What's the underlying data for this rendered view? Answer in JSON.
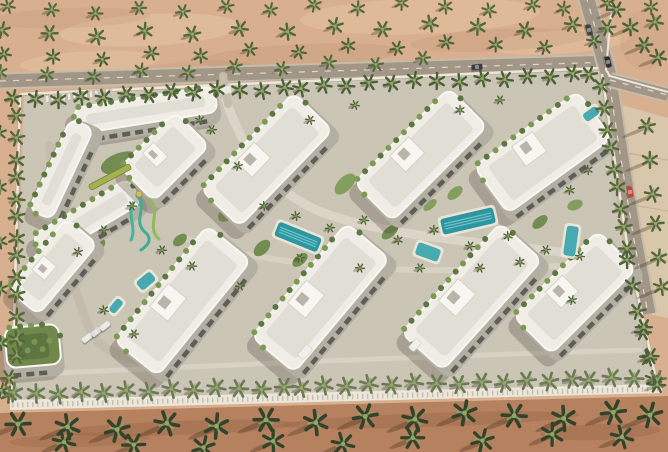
{
  "meta": {
    "description": "Aerial 3D architectural render of a gated residential compound: two rows of white low-rise apartment buildings with rooftop details, central landscaped spine with lap pools and water slides, palm-lined perimeter walls, surrounding desert sand with palm groves, and asphalt roads with cars on the right side.",
    "visible_text": ""
  },
  "palette": {
    "sand_top": "#d8b090",
    "sand_patch_light": "#ecd0ae",
    "sand_patch_dark": "#bb916c",
    "sand_bottom": "#b5815f",
    "pavement": "#d9c7ab",
    "pavement_line": "#c0ab8a",
    "compound_ground": "#cbc5b6",
    "path_light": "#dcd6c8",
    "drive": "#c4bcac",
    "road": "#a29786",
    "road_edge": "#c6bcab",
    "road_dash": "#f3efe5",
    "wall": "#ece7da",
    "wall_shadow": "#9a917f",
    "roof": "#efede6",
    "roof_edge": "#f8f7f2",
    "roof_inner": "#e1ded5",
    "roof_block": "#f7f6f1",
    "facade": "#b3afa3",
    "window": "#4f4f49",
    "hedge1": "#5c7742",
    "hedge2": "#7d9a52",
    "palm": "#55663d",
    "palm_dark": "#4c5f3a",
    "palm_fence_bottom": "#6d7a58",
    "palm_big": "#33422b",
    "palm_center": "#93a765",
    "pool_lap": "#2e96a1",
    "pool_plain": "#46aab0",
    "pool_stripe": "#7bcbce",
    "pool_deck": "#ece9dc",
    "lawn1": "#6d8a4c",
    "lawn2": "#7f9d58",
    "green_roof": "#70894b",
    "green_roof_dark": "#5d7540",
    "shadow": "rgba(62,52,38,0.25)"
  },
  "scene": {
    "width": 668,
    "height": 452,
    "compound_polygon": "24,96 598,68 624,250 656,386 14,404",
    "bottom_band": "0,413 668,396 668,452 0,452",
    "pavement_polygon": "618,104 668,118 668,318 648,314 634,242 622,170",
    "ne_curb": "M612,2 L606,70 L610,76 L668,92",
    "sand_patches": [
      [
        150,
        30,
        90,
        16,
        -3,
        "sand_patch_light",
        0.35
      ],
      [
        420,
        16,
        120,
        18,
        -2,
        "sand_patch_light",
        0.3
      ],
      [
        560,
        42,
        70,
        12,
        -4,
        "sand_patch_light",
        0.3
      ],
      [
        90,
        62,
        70,
        11,
        -3,
        "sand_patch_light",
        0.3
      ],
      [
        300,
        56,
        100,
        12,
        -3,
        "sand_patch_dark",
        0.25
      ],
      [
        70,
        18,
        80,
        10,
        -2,
        "sand_patch_dark",
        0.2
      ],
      [
        500,
        40,
        90,
        11,
        -3,
        "sand_patch_dark",
        0.22
      ],
      [
        200,
        70,
        60,
        9,
        -2,
        "sand_patch_dark",
        0.2
      ],
      [
        645,
        40,
        25,
        30,
        0,
        "sand_patch_dark",
        0.15
      ]
    ],
    "beach_patches": [
      [
        180,
        428,
        120,
        7,
        -2,
        "#8f5f42",
        0.3
      ],
      [
        430,
        420,
        150,
        7,
        -2,
        "#8f5f42",
        0.28
      ],
      [
        600,
        432,
        60,
        8,
        -2,
        "#8f5f42",
        0.3
      ],
      [
        80,
        440,
        70,
        7,
        -2,
        "#8f5f42",
        0.25
      ]
    ],
    "pavement_lines": [
      [
        622,
        152,
        668,
        160
      ],
      [
        626,
        204,
        668,
        211
      ],
      [
        632,
        254,
        668,
        261
      ]
    ],
    "roads": [
      {
        "d": "M0,81 L300,72 L612,62",
        "w": 13
      },
      {
        "d": "M586,-4 L608,72 C616,130 626,190 634,240 L648,314",
        "w": 15
      },
      {
        "d": "M610,80 L668,95",
        "w": 12
      }
    ],
    "walls": [
      "M20,94 L598,68",
      "M20,94 L12,402",
      "M602,74 L628,250 L658,388"
    ],
    "bottom_wall": "10,400 662,384 662,393 10,410",
    "bottom_wall_posts": "M12,405 L660,389",
    "paths": [
      {
        "d": "M226,100 C244,152 272,196 332,216 C402,238 482,242 560,252 C584,256 598,258 606,262",
        "w": 9,
        "c": "path_light",
        "o": 0.9
      },
      {
        "d": "M180,236 C260,268 420,276 558,266",
        "w": 6,
        "c": "path_light",
        "o": 0.7
      },
      {
        "d": "M50,146 C54,210 66,272 90,330 C98,348 118,358 150,361",
        "w": 9,
        "c": "drive",
        "o": 1
      },
      {
        "d": "M36,374 C200,366 430,356 640,350",
        "w": 5,
        "c": "path_light",
        "o": 0.75
      },
      {
        "d": "M223,76 L228,104",
        "w": 8,
        "c": "drive",
        "o": 1
      },
      {
        "d": "M606,262 C616,268 622,276 626,286",
        "w": 6,
        "c": "path_light",
        "o": 0.8
      }
    ],
    "parking": {
      "x1": 46,
      "y1": 99,
      "x2": 112,
      "y2": 92
    },
    "gardens": [
      [
        120,
        163,
        20,
        10,
        -20
      ],
      [
        158,
        186,
        10,
        6,
        -30
      ],
      [
        96,
        247,
        11,
        6,
        -40
      ],
      [
        228,
        212,
        12,
        7,
        -45
      ],
      [
        262,
        248,
        10,
        6,
        -45
      ],
      [
        345,
        184,
        13,
        7,
        -45
      ],
      [
        390,
        232,
        10,
        5,
        -40
      ],
      [
        505,
        248,
        12,
        6,
        -40
      ],
      [
        540,
        222,
        9,
        5,
        -40
      ],
      [
        455,
        193,
        9,
        5,
        -40
      ],
      [
        300,
        260,
        9,
        5,
        -40
      ],
      [
        575,
        205,
        8,
        5,
        -20
      ],
      [
        180,
        240,
        8,
        5,
        -40
      ],
      [
        430,
        205,
        8,
        4,
        -40
      ],
      [
        530,
        280,
        8,
        4,
        -40
      ]
    ],
    "buildings": [
      {
        "cx": 146,
        "cy": 112,
        "len": 142,
        "wid": 26,
        "rot": -9
      },
      {
        "cx": 63,
        "cy": 170,
        "len": 100,
        "wid": 25,
        "rot": -65
      },
      {
        "cx": 88,
        "cy": 221,
        "len": 112,
        "wid": 28,
        "rot": -31
      },
      {
        "cx": 166,
        "cy": 158,
        "len": 78,
        "wid": 48,
        "rot": -45
      },
      {
        "cx": 268,
        "cy": 161,
        "len": 134,
        "wid": 54,
        "rot": -46
      },
      {
        "cx": 422,
        "cy": 156,
        "len": 134,
        "wid": 54,
        "rot": -45
      },
      {
        "cx": 544,
        "cy": 154,
        "len": 128,
        "wid": 58,
        "rot": -36
      },
      {
        "cx": 54,
        "cy": 268,
        "len": 92,
        "wid": 40,
        "rot": -50
      },
      {
        "cx": 184,
        "cy": 302,
        "len": 148,
        "wid": 56,
        "rot": -51
      },
      {
        "cx": 322,
        "cy": 299,
        "len": 148,
        "wid": 56,
        "rot": -50
      },
      {
        "cx": 473,
        "cy": 298,
        "len": 148,
        "wid": 56,
        "rot": -48
      },
      {
        "cx": 576,
        "cy": 294,
        "len": 120,
        "wid": 54,
        "rot": -45
      },
      {
        "cx": 33,
        "cy": 348,
        "len": 54,
        "wid": 40,
        "rot": -5,
        "green_roof": true
      }
    ],
    "banner": {
      "cx": 110,
      "cy": 177,
      "w": 46,
      "h": 6,
      "rot": -28,
      "fill": "#a3b152",
      "stroke": "#77862f"
    },
    "gatehouse": {
      "x": 225,
      "y": 90,
      "w": 13,
      "h": 8,
      "rot": -10
    },
    "pergolas": [
      [
        305,
        352,
        14,
        8,
        -48
      ],
      [
        415,
        345,
        12,
        7,
        -48
      ]
    ],
    "pools": [
      {
        "cx": 298,
        "cy": 237,
        "w": 46,
        "h": 15,
        "rot": 22,
        "style": "lap"
      },
      {
        "cx": 468,
        "cy": 221,
        "w": 54,
        "h": 16,
        "rot": -13,
        "style": "lap"
      },
      {
        "cx": 428,
        "cy": 252,
        "w": 24,
        "h": 13,
        "rot": 20,
        "style": "plain"
      },
      {
        "cx": 146,
        "cy": 281,
        "w": 18,
        "h": 11,
        "rot": -40,
        "style": "plain"
      },
      {
        "cx": 571,
        "cy": 241,
        "w": 12,
        "h": 30,
        "rot": 8,
        "style": "plain"
      },
      {
        "cx": 591,
        "cy": 114,
        "w": 16,
        "h": 9,
        "rot": -36,
        "style": "plain"
      },
      {
        "cx": 116,
        "cy": 306,
        "w": 15,
        "h": 8,
        "rot": -50,
        "style": "plain"
      }
    ],
    "slides": [
      {
        "d": "M137,196 C149,207 131,221 146,233 C153,240 147,246 141,250",
        "c": "#3fae92"
      },
      {
        "d": "M149,199 C163,211 145,227 159,239",
        "c": "#8cbd57"
      },
      {
        "d": "M133,203 C127,215 137,228 131,240",
        "c": "#46b49b"
      }
    ],
    "slide_tower": [
      139,
      194
    ],
    "inner_trees": [
      [
        212,
        130
      ],
      [
        238,
        166
      ],
      [
        264,
        206
      ],
      [
        296,
        216
      ],
      [
        330,
        228
      ],
      [
        364,
        220
      ],
      [
        398,
        240
      ],
      [
        434,
        230
      ],
      [
        470,
        246
      ],
      [
        508,
        236
      ],
      [
        546,
        250
      ],
      [
        580,
        256
      ],
      [
        132,
        206
      ],
      [
        104,
        230
      ],
      [
        78,
        252
      ],
      [
        162,
        250
      ],
      [
        192,
        266
      ],
      [
        104,
        310
      ],
      [
        134,
        334
      ],
      [
        572,
        300
      ],
      [
        240,
        286
      ],
      [
        300,
        258
      ],
      [
        360,
        268
      ],
      [
        420,
        268
      ],
      [
        480,
        268
      ],
      [
        520,
        262
      ],
      [
        200,
        120
      ],
      [
        310,
        120
      ],
      [
        355,
        105
      ],
      [
        460,
        110
      ],
      [
        500,
        100
      ],
      [
        570,
        190
      ],
      [
        588,
        170
      ]
    ],
    "palm_rows": [
      {
        "x1": 14,
        "y1": 10,
        "x2": 655,
        "y2": 5,
        "n": 16,
        "s": 7,
        "c": "palm",
        "sh": 6,
        "j": 1
      },
      {
        "x1": 8,
        "y1": 34,
        "x2": 660,
        "y2": 24,
        "n": 15,
        "s": 8,
        "c": "palm",
        "sh": 7,
        "j": 1
      },
      {
        "x1": 10,
        "y1": 58,
        "x2": 588,
        "y2": 42,
        "n": 13,
        "s": 7,
        "c": "palm_dark",
        "sh": 6,
        "j": 1
      },
      {
        "x1": 6,
        "y1": 76,
        "x2": 420,
        "y2": 62,
        "n": 10,
        "s": 7,
        "c": "palm",
        "sh": 6,
        "j": 1
      },
      {
        "x1": 620,
        "y1": 12,
        "x2": 660,
        "y2": 58,
        "n": 4,
        "s": 8,
        "c": "palm_dark",
        "sh": 12,
        "j": 0.6
      },
      {
        "x1": 16,
        "y1": 100,
        "x2": 592,
        "y2": 74,
        "n": 27,
        "s": 8,
        "c": "palm_dark",
        "sh": 5,
        "j": 0.5
      },
      {
        "x1": 20,
        "y1": 118,
        "x2": 12,
        "y2": 396,
        "n": 15,
        "s": 8,
        "c": "palm",
        "sh": 5,
        "j": 0.6
      },
      {
        "x1": 4,
        "y1": 136,
        "x2": 2,
        "y2": 392,
        "n": 6,
        "s": 7,
        "c": "palm_dark",
        "sh": 5,
        "j": 0.8
      },
      {
        "x1": 604,
        "y1": 88,
        "x2": 626,
        "y2": 248,
        "n": 9,
        "s": 8,
        "c": "palm",
        "sh": 5,
        "j": 0.5
      },
      {
        "x1": 630,
        "y1": 262,
        "x2": 654,
        "y2": 380,
        "n": 6,
        "s": 8,
        "c": "palm_dark",
        "sh": 5,
        "j": 0.5
      },
      {
        "x1": 16,
        "y1": 394,
        "x2": 658,
        "y2": 378,
        "n": 30,
        "s": 9,
        "c": "palm_fence_bottom",
        "sh": 6,
        "j": 0.4
      },
      {
        "x1": 24,
        "y1": 428,
        "x2": 656,
        "y2": 412,
        "n": 14,
        "s": 12,
        "c": "palm_big",
        "sh": 17,
        "j": 1
      },
      {
        "x1": 70,
        "y1": 446,
        "x2": 620,
        "y2": 436,
        "n": 9,
        "s": 11,
        "c": "palm_big",
        "sh": 14,
        "j": 1
      },
      {
        "x1": 650,
        "y1": 128,
        "x2": 662,
        "y2": 288,
        "n": 6,
        "s": 8,
        "c": "palm",
        "sh": 15,
        "j": 0.5
      },
      {
        "x1": 648,
        "y1": 330,
        "x2": 660,
        "y2": 382,
        "n": 3,
        "s": 8,
        "c": "palm_dark",
        "sh": 8,
        "j": 0.7
      }
    ],
    "cars": [
      {
        "x": 589,
        "y": 30,
        "rot": 74,
        "c": "#3c4043"
      },
      {
        "x": 608,
        "y": 62,
        "rot": 76,
        "c": "#2b2e30"
      },
      {
        "x": 630,
        "y": 192,
        "rot": 78,
        "c": "#bf4337"
      },
      {
        "x": 477,
        "y": 67,
        "rot": -7,
        "c": "#3a3d3f"
      },
      {
        "x": 87,
        "y": 338,
        "rot": -38,
        "c": "#e8e9e6"
      },
      {
        "x": 96,
        "y": 332,
        "rot": -38,
        "c": "#dcdedb"
      },
      {
        "x": 105,
        "y": 326,
        "rot": -38,
        "c": "#e8e9e6"
      }
    ]
  }
}
